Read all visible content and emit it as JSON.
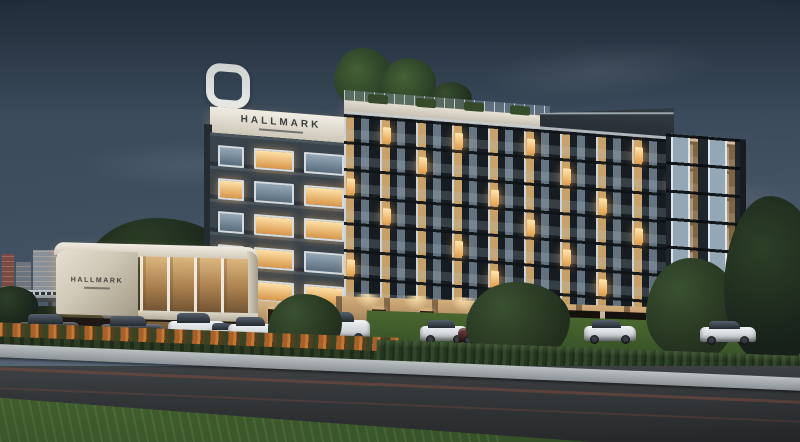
{
  "scene": {
    "type": "architectural-dusk-rendering",
    "subject": "Seven-storey HALLMARK condominium with rooftop garden, entrance pavilion, parked cars and elevated train in background"
  },
  "signs": {
    "rooftop": "HALLMARK",
    "entrance": "HALLMARK"
  },
  "palette": {
    "sky_top": "#33424f",
    "sky_horizon": "#939ca6",
    "facade_dark": "#39434b",
    "parapet_white": "#f2eee4",
    "window_warm": "#ffe2a8",
    "window_cool": "#93a7b6",
    "ground_floor_warm": "#d3ae7c",
    "grass": "#44612f",
    "hedge_flower_orange": "#c47a33",
    "hedge_green": "#31452a",
    "road_asphalt": "#323537",
    "curb": "#bcc1c4",
    "marble_sign": "#e6e0d3"
  }
}
